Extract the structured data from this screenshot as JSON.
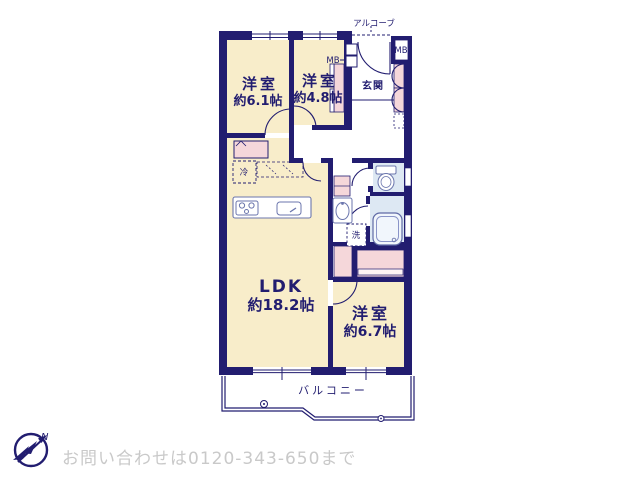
{
  "plan": {
    "bedroom1": {
      "label": "洋室",
      "size": "約6.1帖"
    },
    "bedroom2": {
      "label": "洋室",
      "size": "約4.8帖"
    },
    "bedroom3": {
      "label": "洋室",
      "size": "約6.7帖"
    },
    "ldk": {
      "label": "LDK",
      "size": "約18.2帖"
    },
    "entrance_label": "玄関",
    "alcove_label": "アルコーブ",
    "balcony_label": "バルコニー",
    "mb_left": "MB",
    "mb_right": "MB",
    "fridge_label": "冷",
    "washer_label": "洗",
    "compass_north": "N",
    "colors": {
      "wall": "#221d70",
      "room_floor": "#f8edca",
      "closet": "#f5d7da",
      "wet_area": "#dde8f3"
    }
  },
  "footer": {
    "contact": "お問い合わせは0120-343-650まで"
  }
}
